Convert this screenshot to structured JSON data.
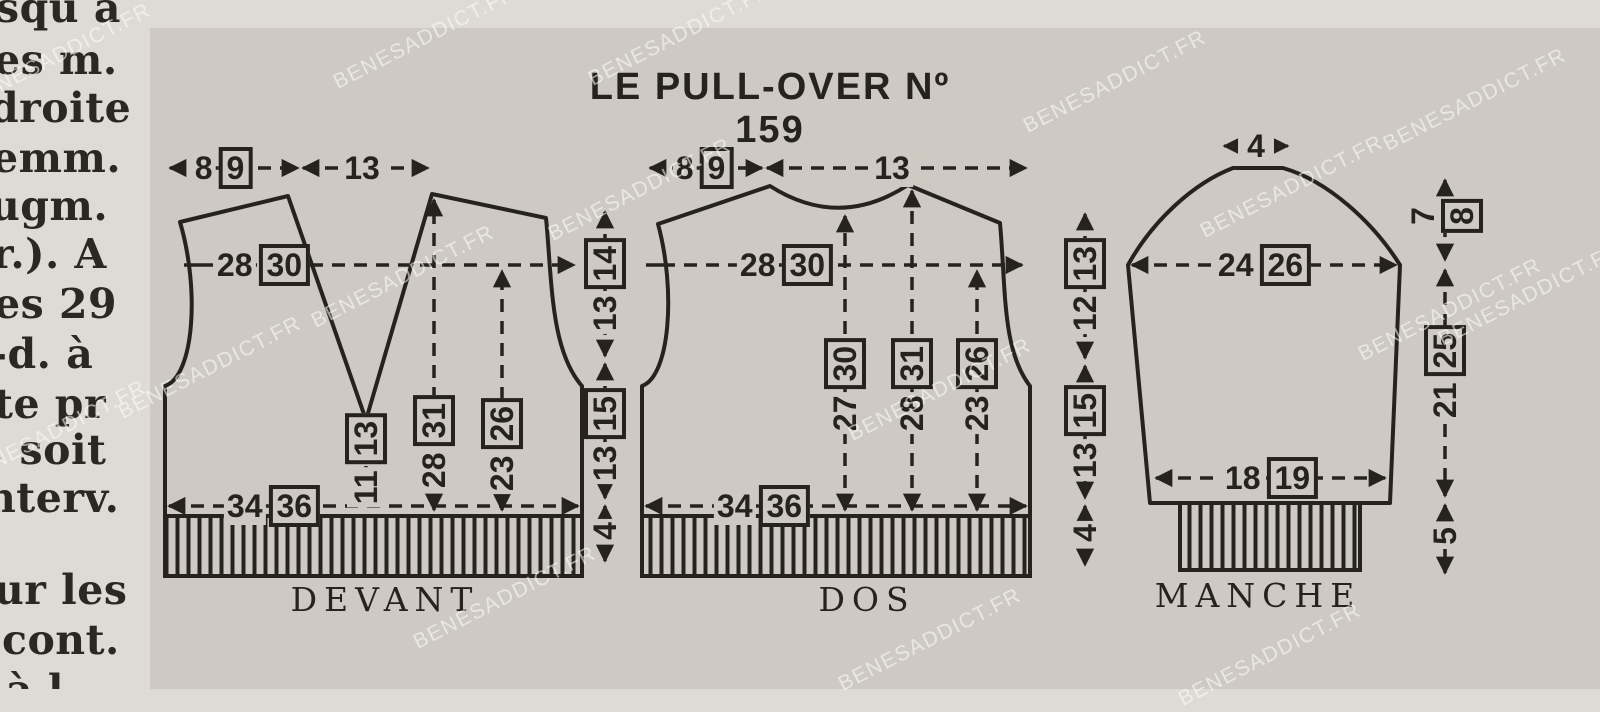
{
  "colors": {
    "ink": "#26231f",
    "paper": "#dedad4",
    "inset": "#cecac3"
  },
  "watermark_text": "BENESADDICT.FR",
  "title": "LE PULL-OVER Nº 159",
  "left_column": {
    "lines": [
      "squ à",
      "es m.",
      "droite",
      "emm.",
      "ugm.",
      "r.). A",
      "es 29",
      "-d. à",
      "te pr",
      ", soit",
      "nterv.",
      "ur les",
      "cont.",
      "à l"
    ]
  },
  "devant": {
    "label": "DEVANT",
    "shoulder": {
      "main": "8",
      "alt": "9"
    },
    "neck": {
      "main": "13"
    },
    "bust": {
      "main": "28",
      "alt": "30"
    },
    "vneck_depth": {
      "main": "11",
      "alt": "13"
    },
    "shoulder_height": {
      "main": "28",
      "alt": "31"
    },
    "armhole_height": {
      "main": "23",
      "alt": "26"
    },
    "hem": {
      "main": "34",
      "alt": "36"
    }
  },
  "dos": {
    "label": "DOS",
    "shoulder": {
      "main": "8",
      "alt": "9"
    },
    "neck": {
      "main": "13"
    },
    "bust": {
      "main": "28",
      "alt": "30"
    },
    "neck_height": {
      "main": "27",
      "alt": "30"
    },
    "shoulder_height": {
      "main": "28",
      "alt": "31"
    },
    "armhole_height": {
      "main": "23",
      "alt": "26"
    },
    "hem": {
      "main": "34",
      "alt": "36"
    }
  },
  "manche": {
    "label": "MANCHE",
    "cap_top": {
      "main": "4"
    },
    "cap_height": {
      "main": "7",
      "alt": "8"
    },
    "top_width": {
      "main": "24",
      "alt": "26"
    },
    "length": {
      "main": "21",
      "alt": "25"
    },
    "cuff_height": {
      "main": "5"
    },
    "cuff_width": {
      "main": "18",
      "alt": "19"
    }
  },
  "dim_devant_dos": {
    "armhole": {
      "main": "13",
      "alt": "14"
    },
    "side": {
      "main": "13",
      "alt": "15"
    },
    "rib": {
      "main": "4"
    }
  },
  "dim_dos_manche": {
    "armhole": {
      "main": "12",
      "alt": "13"
    },
    "side": {
      "main": "13",
      "alt": "15"
    },
    "rib": {
      "main": "4"
    }
  }
}
